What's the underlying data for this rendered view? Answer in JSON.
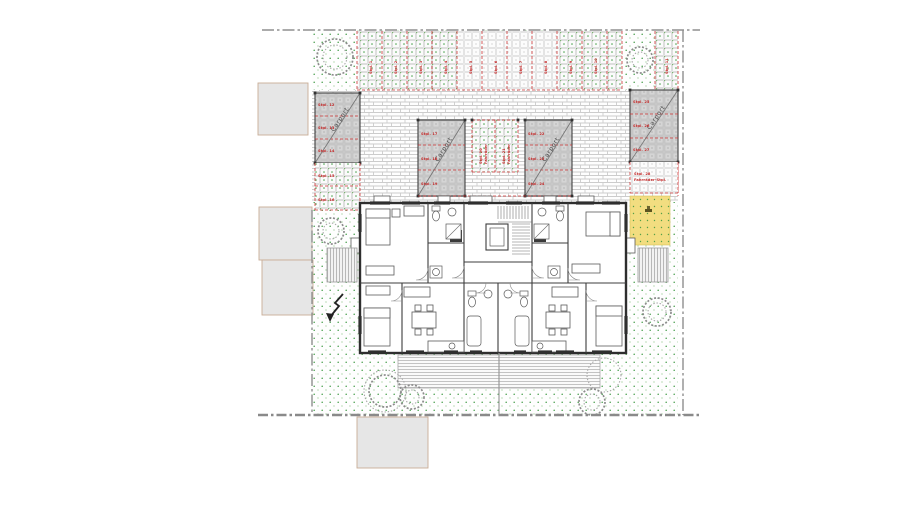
{
  "labels": {
    "carport": "Carport"
  },
  "parking": {
    "top_row": [
      "Stpl. 1",
      "Stpl. 2",
      "Stpl. 3",
      "Stpl. 4",
      "Stpl. 5",
      "Stpl. 6",
      "Stpl. 7",
      "Stpl. 8",
      "Stpl. 9",
      "Stpl. 10",
      "Stpl. 11"
    ],
    "left_carport": [
      "Stpl. 12",
      "Stpl. 13",
      "Stpl. 14"
    ],
    "left_open": [
      "Stpl. 15",
      "Stpl. 16"
    ],
    "center_left_carport": [
      "Stpl. 17",
      "Stpl. 18",
      "Stpl. 19"
    ],
    "center_open": [
      {
        "line1": "Stpl. 20",
        "line2": "Fahrräder"
      },
      {
        "line1": "Stpl. 21",
        "line2": "Fahrräder"
      }
    ],
    "center_right_carport": [
      "Stpl. 22",
      "Stpl. 23",
      "Stpl. 24"
    ],
    "right_carport": [
      "Stpl. 25",
      "Stpl. 26",
      "Stpl. 27"
    ],
    "right_open": {
      "line1": "Stpl. 28",
      "line2": "Fahrräder-Stpl."
    }
  },
  "colors": {
    "accent_red": "#c42a2a",
    "lawn_dot_green": "#48a04c",
    "carport_gray": "#cbcbcb",
    "sand_yellow": "#f2dd80",
    "neighbor_gray": "#e6e6e6",
    "wall_dark": "#2e2e2e",
    "boundary_gray": "#8f8f8f"
  }
}
